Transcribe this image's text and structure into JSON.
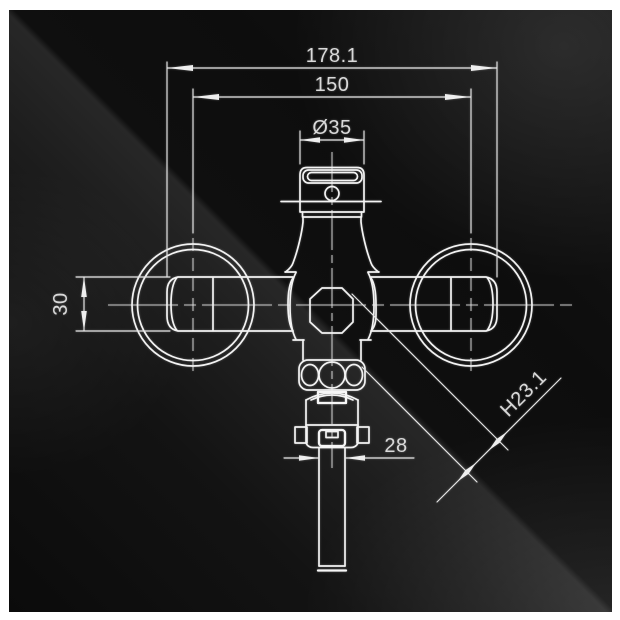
{
  "drawing": {
    "type": "front-elevation wireframe technical drawing",
    "subject": "wall-mount two-handle faucet with bottom spout",
    "line_color": "#f3f3f3",
    "text_color": "#d9d9d9",
    "background_color": "#101010",
    "frame_color": "#ffffff"
  },
  "dimensions": {
    "overall_width": "178.1",
    "handle_centers": "150",
    "cap_diameter": "Ø35",
    "handle_height": "30",
    "spout_width": "28",
    "diagonal_clearance": "H23.1"
  }
}
